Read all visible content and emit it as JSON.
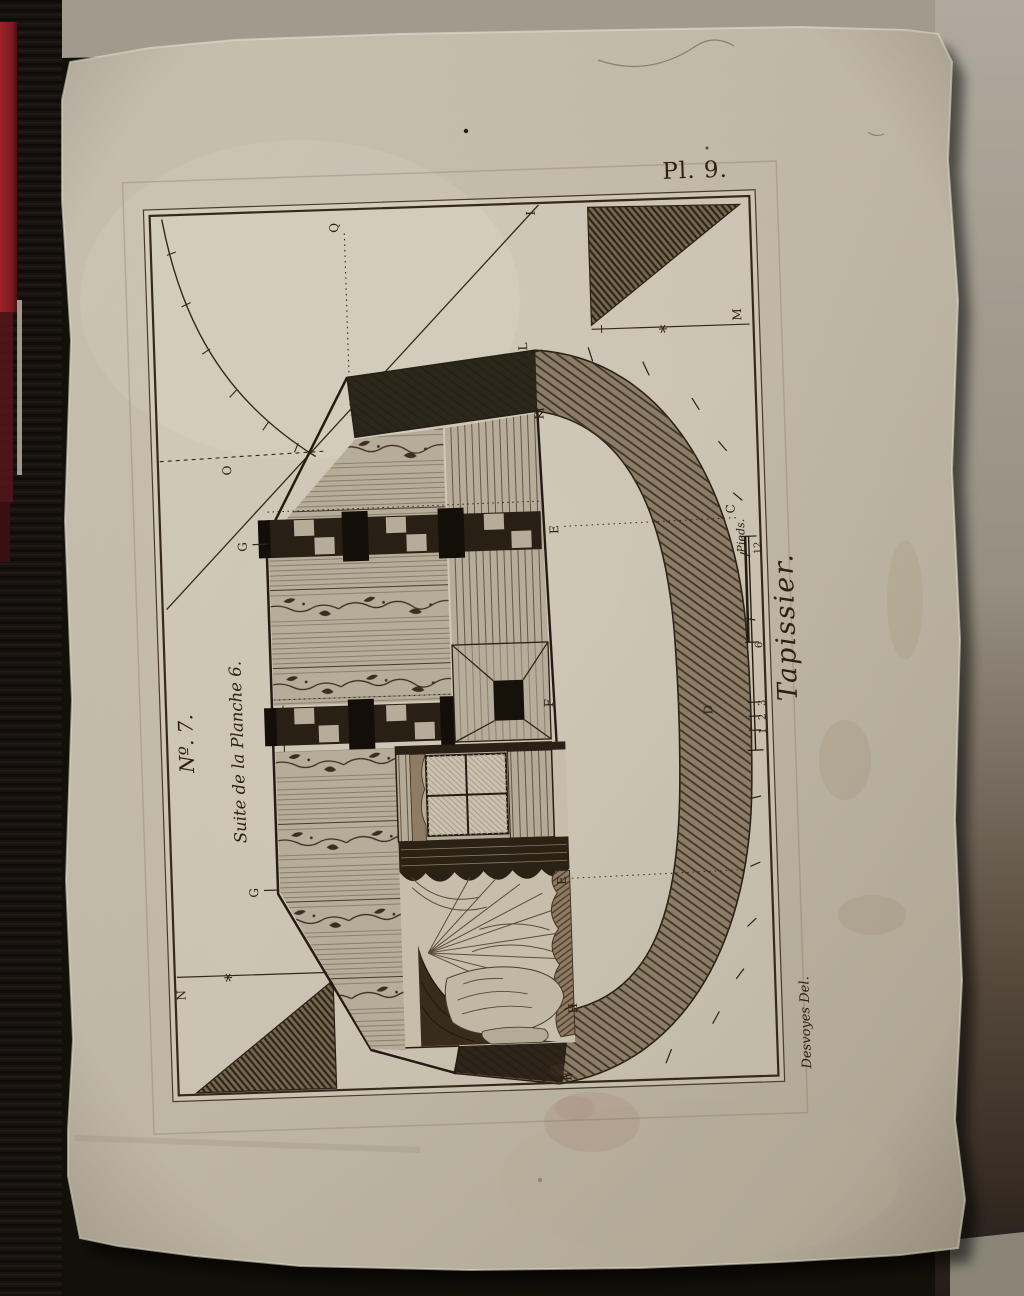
{
  "photo": {
    "description": "Photograph of an antique engraved encyclopedia plate on laid paper",
    "colors": {
      "paper": "#c7bfad",
      "ink": "#2b2114",
      "red_spine": "#8d2026",
      "backdrop": "#a39d90",
      "shelf": "#191310"
    }
  },
  "plate": {
    "number": "Pl. 9.",
    "series_number": "Nº. 7.",
    "series_subtitle": "Suite de la Planche 6.",
    "side_title": "Tapissier.",
    "signature": "Desvoyes Del.",
    "scale": {
      "corner_label": "C",
      "unit_label": "Pieds.",
      "ticks": [
        "12",
        "6",
        "3",
        "2",
        "1"
      ]
    },
    "point_labels": {
      "q": "Q",
      "i": "I",
      "o": "O",
      "m": "M",
      "n": "N",
      "g_upper": "G",
      "g_lower": "G",
      "l": "L",
      "k": "K",
      "e_upper": "E",
      "f": "F",
      "e_lower": "E",
      "h": "H",
      "b": "B",
      "d": "D"
    },
    "marks": {
      "asterisk": "*"
    }
  }
}
